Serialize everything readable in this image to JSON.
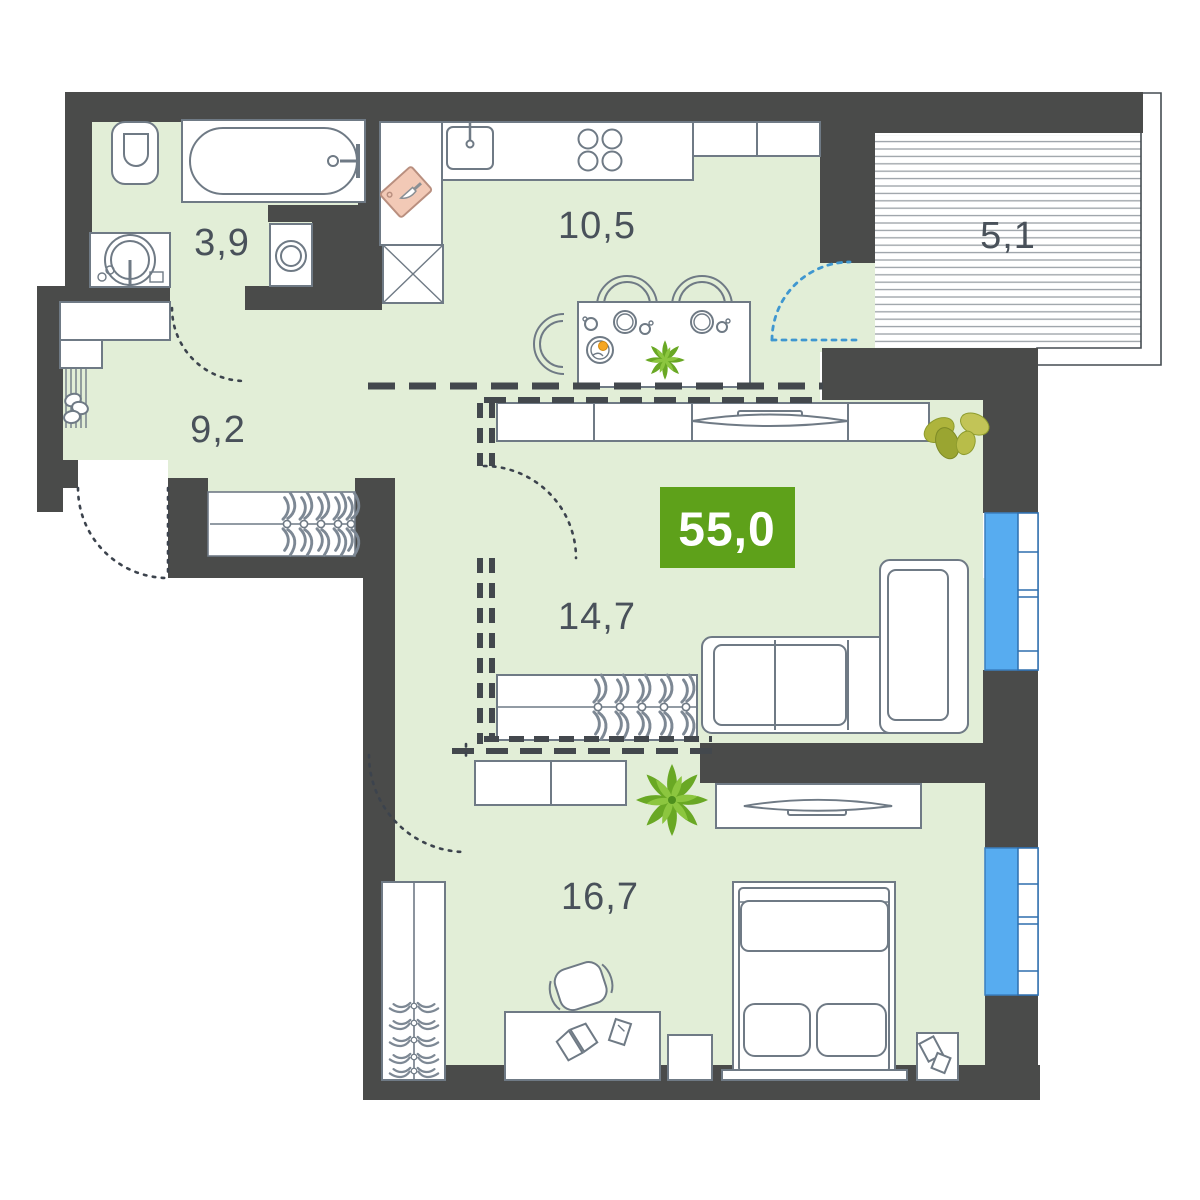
{
  "plan": {
    "type": "apartment-floor-plan",
    "total_area": {
      "value": "55,0"
    },
    "rooms": [
      {
        "id": "bathroom",
        "area": "3,9"
      },
      {
        "id": "kitchen",
        "area": "10,5"
      },
      {
        "id": "balcony",
        "area": "5,1"
      },
      {
        "id": "hallway",
        "area": "9,2"
      },
      {
        "id": "living-room",
        "area": "14,7"
      },
      {
        "id": "bedroom",
        "area": "16,7"
      }
    ],
    "colors": {
      "floor": "#e2eed7",
      "wall": "#4a4b4a",
      "badge_green": "#5ea11a",
      "window_blue": "#57acf0",
      "balcony_door_arc": "#3f97d0",
      "furniture_stroke": "#6f7a85",
      "label_text": "#49515a",
      "cutting_board": "#f2c9b6"
    }
  }
}
